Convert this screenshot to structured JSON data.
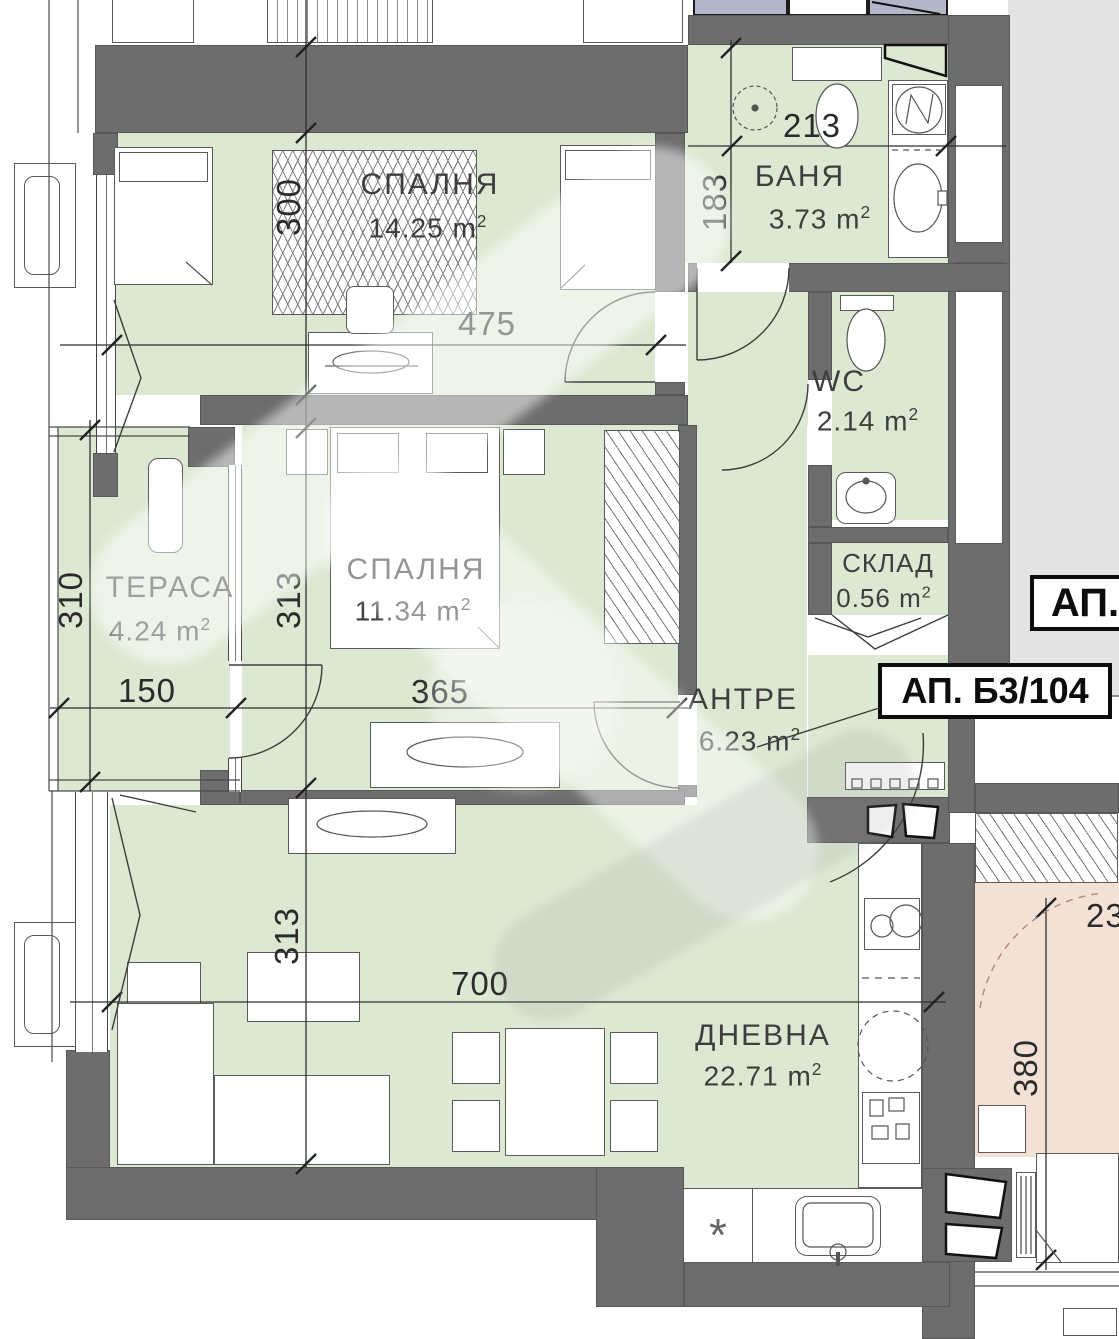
{
  "badges": {
    "partial": "АП.",
    "full": "АП. Б3/104"
  },
  "units": {
    "m": "m",
    "sup": "2"
  },
  "rooms": [
    {
      "key": "bedroom1",
      "name": "СПАЛНЯ",
      "area": "14.25"
    },
    {
      "key": "bathroom",
      "name": "БАНЯ",
      "area": "3.73"
    },
    {
      "key": "wc",
      "name": "WC",
      "area": "2.14"
    },
    {
      "key": "storage",
      "name": "СКЛАД",
      "area": "0.56"
    },
    {
      "key": "terrace",
      "name": "ТЕРАСА",
      "area": "4.24"
    },
    {
      "key": "bedroom2",
      "name": "СПАЛНЯ",
      "area": "11.34"
    },
    {
      "key": "hall",
      "name": "АНТРЕ",
      "area": "6.23"
    },
    {
      "key": "living",
      "name": "ДНЕВНА",
      "area": "22.71"
    }
  ],
  "dims": {
    "bedroom1_h": "300",
    "bedroom1_w": "475",
    "bath_w": "213",
    "bath_h": "183",
    "terrace_h": "310",
    "terrace_w": "150",
    "bedroom2_h": "313",
    "bedroom2_w": "365",
    "living_h": "313",
    "living_w": "700",
    "neighbor_h": "380",
    "neighbor_w_partial": "23"
  },
  "symbols": {
    "dishwasher_star": "*"
  },
  "colors": {
    "floor": "#dce8d2",
    "wall": "#6d6d6d",
    "neighbor_floor": "#f2e1d4",
    "upper_unit": "#b4b7c9",
    "background": "#e3e3e3"
  }
}
